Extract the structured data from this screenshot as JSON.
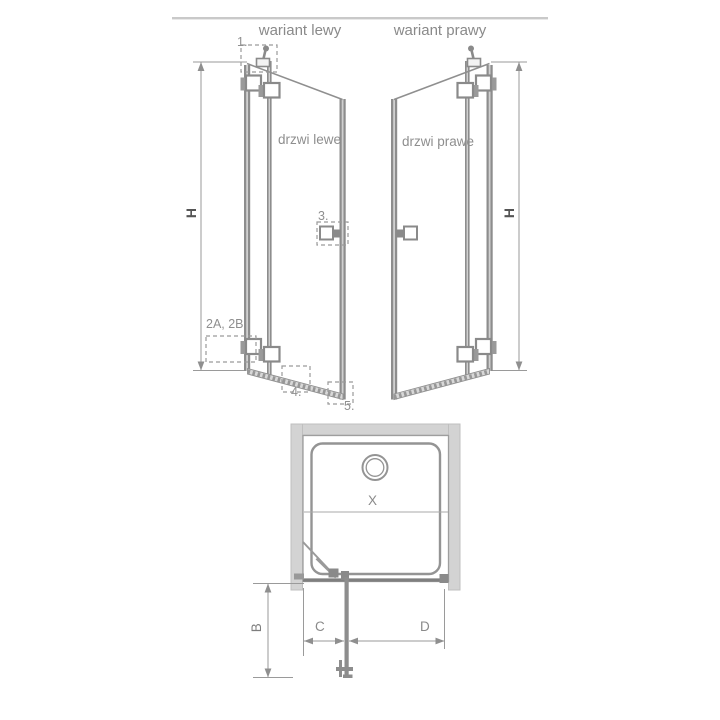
{
  "title": "shower-door-technical-diagram",
  "header": {
    "variant_left": "wariant lewy",
    "variant_right": "wariant prawy"
  },
  "doors": {
    "left": "drzwi lewe",
    "right": "drzwi prawe"
  },
  "callouts": {
    "item1": "1.",
    "item2": "2A, 2B",
    "item3": "3.",
    "item4": "4.",
    "item5": "5."
  },
  "dimensions": {
    "height_left": "H",
    "height_right": "H",
    "tray_width": "X",
    "depth": "B",
    "door_offset": "C",
    "door_width": "D"
  },
  "colors": {
    "line": "#8f8f8f",
    "profile": "#8d8d8d",
    "profile_highlight": "#d0d0d0",
    "wall_fill": "#d3d3d3",
    "hardware": "#8a8a8a",
    "text": "#8a8a8a",
    "dim_text": "#555555",
    "top_rule": "#c9c9c9"
  }
}
